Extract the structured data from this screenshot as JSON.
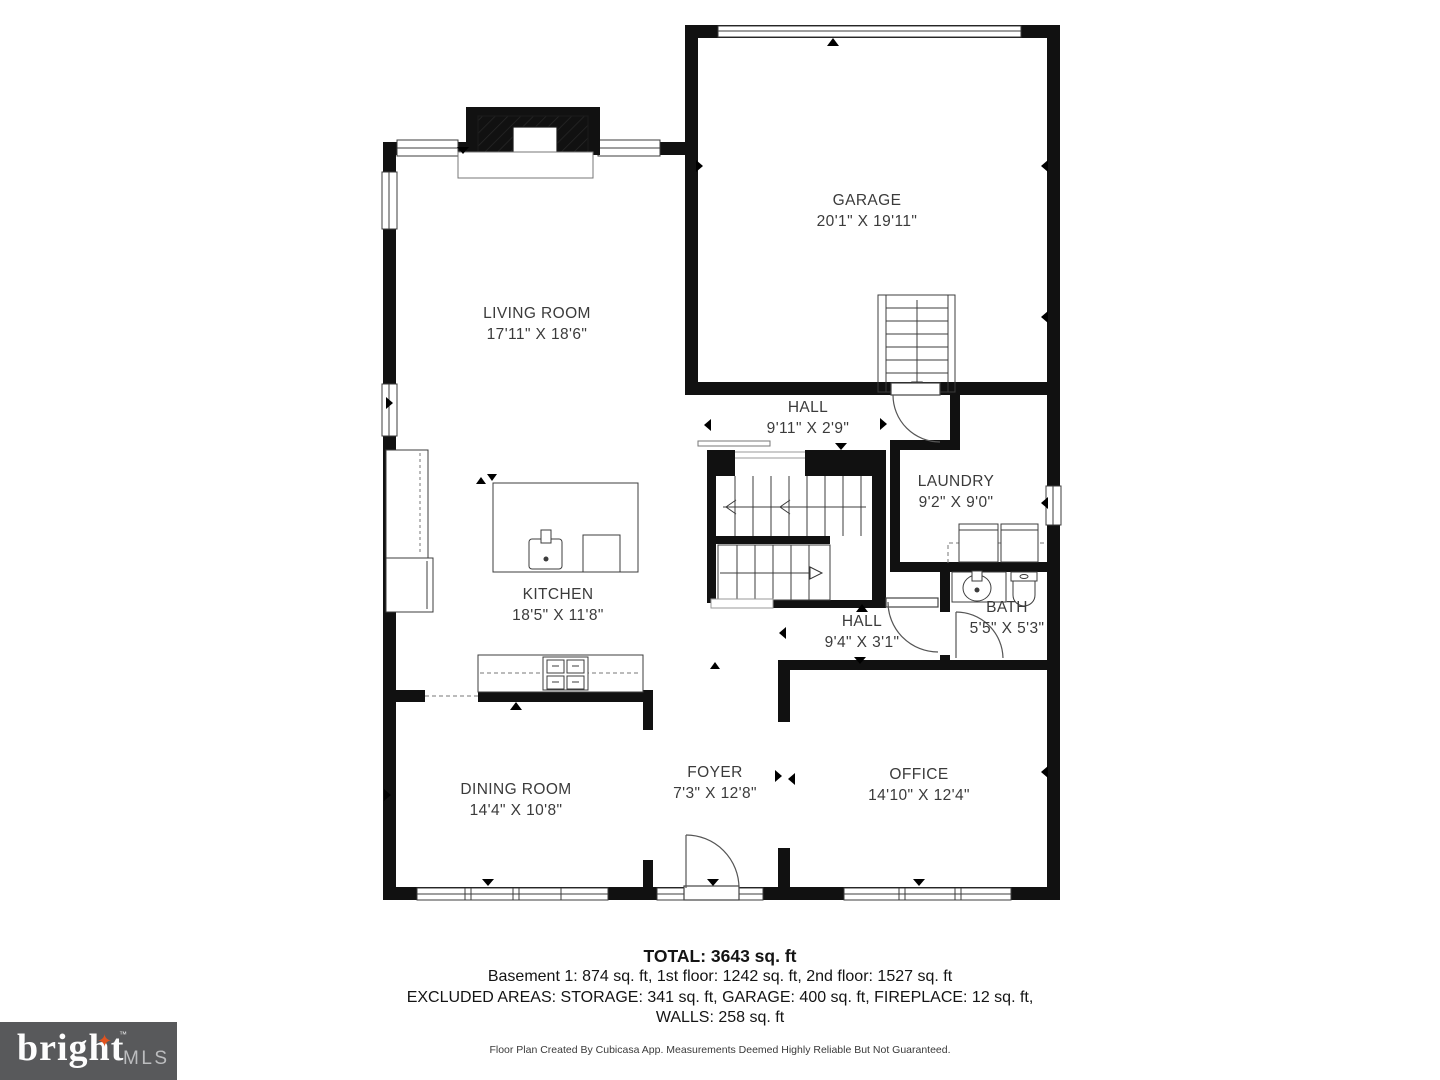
{
  "plan": {
    "rooms": [
      {
        "id": "garage",
        "name": "GARAGE",
        "dims": "20'1\" X 19'11\""
      },
      {
        "id": "living",
        "name": "LIVING ROOM",
        "dims": "17'11\" X 18'6\""
      },
      {
        "id": "hall-upper",
        "name": "HALL",
        "dims": "9'11\" X 2'9\""
      },
      {
        "id": "laundry",
        "name": "LAUNDRY",
        "dims": "9'2\" X 9'0\""
      },
      {
        "id": "kitchen",
        "name": "KITCHEN",
        "dims": "18'5\" X 11'8\""
      },
      {
        "id": "hall-lower",
        "name": "HALL",
        "dims": "9'4\" X 3'1\""
      },
      {
        "id": "bath",
        "name": "BATH",
        "dims": "5'5\" X 5'3\""
      },
      {
        "id": "dining",
        "name": "DINING ROOM",
        "dims": "14'4\" X 10'8\""
      },
      {
        "id": "foyer",
        "name": "FOYER",
        "dims": "7'3\" X 12'8\""
      },
      {
        "id": "office",
        "name": "OFFICE",
        "dims": "14'10\" X 12'4\""
      }
    ]
  },
  "summary": {
    "total": "TOTAL: 3643 sq. ft",
    "line1": "Basement 1: 874 sq. ft, 1st floor: 1242 sq. ft, 2nd floor: 1527 sq. ft",
    "line2": "EXCLUDED AREAS: STORAGE: 341 sq. ft, GARAGE: 400 sq. ft, FIREPLACE: 12 sq. ft,",
    "line3": "WALLS: 258 sq. ft",
    "footer": "Floor Plan Created By Cubicasa App. Measurements Deemed Highly Reliable But Not Guaranteed."
  },
  "logo": {
    "brand": "bright",
    "suffix": "MLS",
    "tm": "™",
    "star_glyph": "✦",
    "bg_color": "#58595b",
    "star_color": "#e0531f"
  },
  "colors": {
    "walls": "#111111",
    "fixture_lines": "#444444",
    "label_text": "#3b3b3b"
  }
}
